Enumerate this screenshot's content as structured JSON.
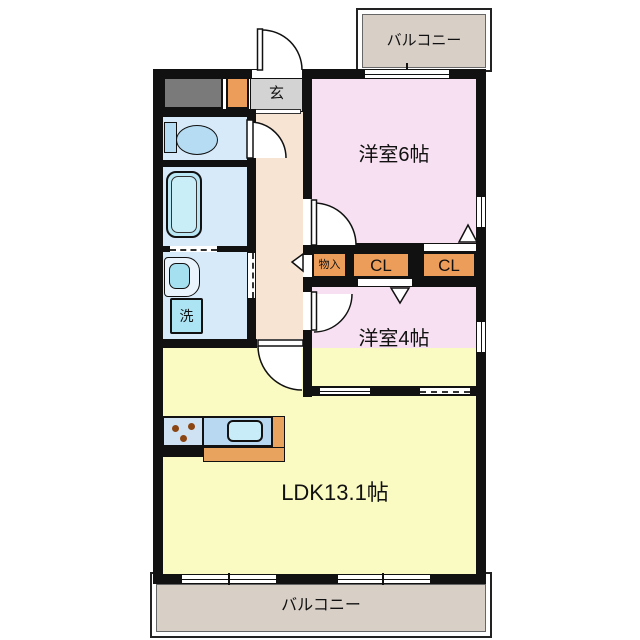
{
  "plan": {
    "rooms": {
      "western6": {
        "label": "洋室6帖"
      },
      "western4": {
        "label": "洋室4帖"
      },
      "ldk": {
        "label": "LDK13.1帖"
      },
      "entrance": {
        "label": "玄"
      },
      "laundry_pan": {
        "label": "洗"
      },
      "storage": {
        "label": "物入"
      },
      "closet_a": {
        "label": "CL"
      },
      "closet_b": {
        "label": "CL"
      },
      "balcony_top": {
        "label": "バルコニー"
      },
      "balcony_bottom": {
        "label": "バルコニー"
      }
    },
    "colors": {
      "room_pink": "#f8e0f3",
      "ldk_yellow": "#fafac3",
      "hall_peach": "#f8e4d3",
      "closet_orange": "#ec9d5a",
      "wet_area_blue": "#d6eafa",
      "balcony_tan": "#d8cfc6",
      "wall_black": "#111111",
      "fixture_blue": "#b5dcf2",
      "counter_blue": "#b8d7f0",
      "kitchen_orange": "#e8a35f"
    }
  }
}
